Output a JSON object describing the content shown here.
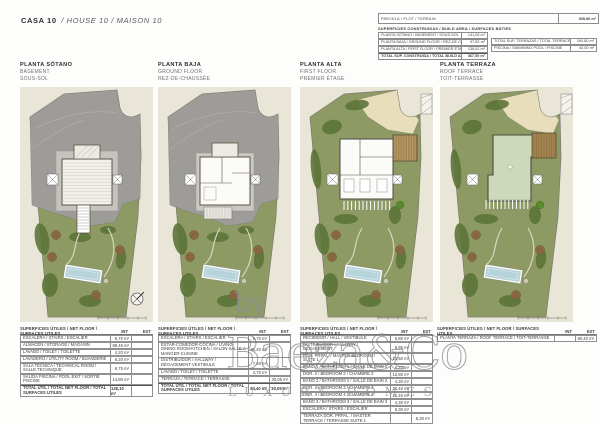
{
  "header": {
    "title_bold": "CASA 10",
    "title_rest": "/ HOUSE 10 / MAISON 10"
  },
  "summary": {
    "parcel": {
      "label": "PARCELA / PLOT / TERRAIN",
      "value": "935,80 m²"
    },
    "built_label": "SUPERFICIES CONSTRUIDAS / BUILD AREA / SURFACES BÂTIES",
    "built_rows": [
      {
        "label": "PLANTA SÓTANO / BASEMENT / SOUS-SOL",
        "value": "131,06 m²",
        "bold": false
      },
      {
        "label": "PLANTA BAJA / GROUND FLOOR / REZ-DE-CHAUSSÉE",
        "value": "97,82 m²",
        "bold": false
      },
      {
        "label": "PLANTA ALTA / FIRST FLOOR / PREMIER ÉTAGE",
        "value": "138,62 m²",
        "bold": false
      },
      {
        "label": "TOTAL SUP. CONSTRUIDA / TOTAL BUILD AREA / TOTAL SURFACES BÂTIES",
        "value": "367,50 m²",
        "bold": true
      }
    ],
    "side_rows": [
      {
        "label": "TOTAL SUP. TERRAZAS / TOTAL TERRACES / TOTAL SURFACES TERRASSES",
        "value": "160,80 m²",
        "bold": false
      },
      {
        "label": "PISCINA / SWIMMING POOL / PISCINE",
        "value": "40,00 m²",
        "bold": false
      }
    ]
  },
  "plans": [
    {
      "title": "PLANTA SÓTANO",
      "subtitle1": "BASEMENT",
      "subtitle2": "SOUS-SOL",
      "variant": "basement"
    },
    {
      "title": "PLANTA BAJA",
      "subtitle1": "GROUND FLOOR",
      "subtitle2": "REZ-DE-CHAUSSÉE",
      "variant": "ground"
    },
    {
      "title": "PLANTA ALTA",
      "subtitle1": "FIRST FLOOR",
      "subtitle2": "PREMIER ÉTAGE",
      "variant": "first"
    },
    {
      "title": "PLANTA TERRAZA",
      "subtitle1": "ROOF TERRACE",
      "subtitle2": "TOIT-TERRASSE",
      "variant": "roof"
    }
  ],
  "tables": [
    {
      "header": "SUPERFICIES ÚTILES / NET FLOOR / SURFACES UTILES",
      "col_int": "INT",
      "col_ext": "EXT",
      "rows": [
        {
          "label": "ESCALERA / STAIRS / ESCALIER",
          "int": "6,70 m²",
          "ext": "",
          "bold": false
        },
        {
          "label": "ALMACÉN / STORAGE / MAGASIN",
          "int": "89,45 m²",
          "ext": "",
          "bold": false
        },
        {
          "label": "LAVABO / TOILET / TOILETTE",
          "int": "4,20 m²",
          "ext": "",
          "bold": false
        },
        {
          "label": "LAVADERO / UTILITY ROOM / BUANDERIE",
          "int": "6,20 m²",
          "ext": "",
          "bold": false
        },
        {
          "label": "SALA TÉCNICA / TECHNICAL ROOM / SALLE TECHNIQUE",
          "int": "6,75 m²",
          "ext": "",
          "bold": false
        },
        {
          "label": "SALIDA PISCINA / POOL EXIT / SORTIE PISCINE",
          "int": "14,80 m²",
          "ext": "",
          "bold": false
        },
        {
          "label": "TOTAL ÚTIL / TOTAL NET FLOOR / TOTAL SURFACES UTILES",
          "int": "128,10 m²",
          "ext": "",
          "bold": true
        }
      ]
    },
    {
      "header": "SUPERFICIES ÚTILES / NET FLOOR / SURFACES UTILES",
      "col_int": "INT",
      "col_ext": "EXT",
      "rows": [
        {
          "label": "ESCALERA / STAIRS / ESCALIER",
          "int": "6,70 m²",
          "ext": "",
          "bold": false
        },
        {
          "label": "ESTAR-COMEDOR-COCINA / LIVING-DINING ROOM-KITCHEN / SALON-SALLE À MANGER-CUISINE",
          "int": "65,40 m²",
          "ext": "",
          "bold": false
        },
        {
          "label": "DISTRIBUIDOR / HALLWAY / DÉGAGEMENT-VESTIBULE",
          "int": "7,60 m²",
          "ext": "",
          "bold": false
        },
        {
          "label": "LAVABO / TOILET / TOILETTE",
          "int": "4,70 m²",
          "ext": "",
          "bold": false
        },
        {
          "label": "TERRAZA / TERRACE / TERRASSE",
          "int": "",
          "ext": "30,05 m²",
          "bold": false
        },
        {
          "label": "TOTAL ÚTIL / TOTAL NET FLOOR / TOTAL SURFACES UTILES",
          "int": "84,40 m²",
          "ext": "30,05 m²",
          "bold": true
        }
      ]
    },
    {
      "header": "SUPERFICIES ÚTILES / NET FLOOR / SURFACES UTILES",
      "col_int": "INT",
      "col_ext": "EXT",
      "rows": [
        {
          "label": "RECIBIDOR / HALL / VESTIBULE",
          "int": "5,80 m²",
          "ext": "",
          "bold": false
        },
        {
          "label": "DISTRIBUIDOR / HALLWAY / DÉGAGEMENT",
          "int": "8,95 m²",
          "ext": "",
          "bold": false
        },
        {
          "label": "DOR. PRPAL. / MASTER BEDROOM / SUITE 1",
          "int": "18,50 m²",
          "ext": "",
          "bold": false
        },
        {
          "label": "BAÑO 1 / BATHROOM 1 / SALLE DE BAIN 1",
          "int": "5,20 m²",
          "ext": "",
          "bold": false
        },
        {
          "label": "DOR. 2 / BEDROOM 2 / CHAMBRE 2",
          "int": "12,80 m²",
          "ext": "",
          "bold": false
        },
        {
          "label": "BAÑO 2 / BATHROOM 2 / SALLE DE BAIN 2",
          "int": "4,30 m²",
          "ext": "",
          "bold": false
        },
        {
          "label": "DOR. 3 / BEDROOM 3 / CHAMBRE 3",
          "int": "12,40 m²",
          "ext": "",
          "bold": false
        },
        {
          "label": "DOR. 4 / BEDROOM 4 / CHAMBRE 4",
          "int": "12,40 m²",
          "ext": "",
          "bold": false
        },
        {
          "label": "BAÑO 3 / BATHROOM 3 / SALLE DE BAIN 3",
          "int": "4,30 m²",
          "ext": "",
          "bold": false
        },
        {
          "label": "ESCALERA / STAIRS / ESCALIER",
          "int": "6,30 m²",
          "ext": "",
          "bold": false
        },
        {
          "label": "TERRAZA DOR. PRPAL. / MASTER TERRACE / TERRASSE SUITE 1",
          "int": "",
          "ext": "6,30 m²",
          "bold": false
        },
        {
          "label": "APARCAMIENTO / PARKING / PARKING",
          "int": "",
          "ext": "32,40 m²",
          "bold": false
        },
        {
          "label": "TOTAL ÚTIL / TOTAL NET FLOOR / TOTAL SURFACES UTILES",
          "int": "90,95 m²",
          "ext": "38,70 m²",
          "bold": true
        }
      ]
    },
    {
      "header": "SUPERFICIES ÚTILES / NET FLOOR / SURFACES UTILES",
      "col_int": "INT",
      "col_ext": "EXT",
      "rows": [
        {
          "label": "PLANTA TERRAZA / ROOF TERRACE / TOIT-TERRASSE",
          "int": "",
          "ext": "80,40 m²",
          "bold": false
        }
      ]
    }
  ],
  "watermark": {
    "by": "by",
    "name": "Baeza&Co",
    "tagline": "LUXURY HOMES"
  },
  "colors": {
    "panel_bg": "#eae6d7",
    "grass": "#8e9a63",
    "grass_dark": "#5c7439",
    "bush_bright": "#5a8a2e",
    "terrain_gray": "#9d9c99",
    "sand": "#e8debb",
    "pool_blue": "#b7d3da",
    "deck_brown": "#a5854f",
    "roof_green": "#ccd9ba",
    "tree_brown": "#8a6a42",
    "path_light": "#d9d5c2",
    "outline": "#7a796f",
    "wall": "#5f5244"
  }
}
